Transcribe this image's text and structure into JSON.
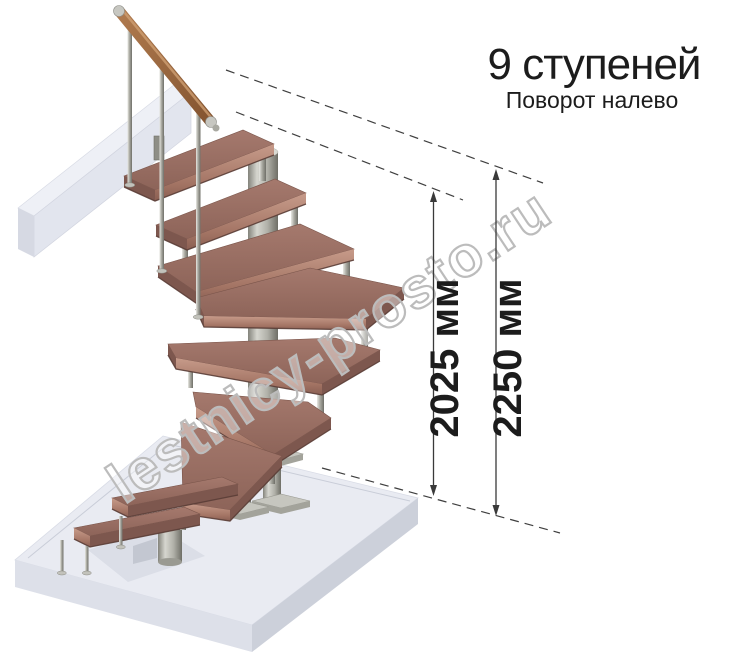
{
  "title": {
    "steps_count": "9 ступеней",
    "turn_direction": "Поворот налево"
  },
  "dimensions": {
    "stair_height": {
      "label": "2025 мм"
    },
    "total_height": {
      "label": "2250 мм"
    }
  },
  "watermark": {
    "text": "lestnicy-prosto.ru"
  },
  "figure": {
    "type": "3d-staircase-render",
    "treads_visible": 9
  },
  "colors": {
    "tread_wood": "#9a6f64",
    "tread_edge": "#c79b8a",
    "handrail_wood": "#a06a42",
    "metal": "#b5b5ae",
    "floor_concrete": "#e9ebf2",
    "text": "#1c1c1c",
    "dimension_line": "#3a3a3a",
    "watermark_outline": "#bcbcbc"
  }
}
